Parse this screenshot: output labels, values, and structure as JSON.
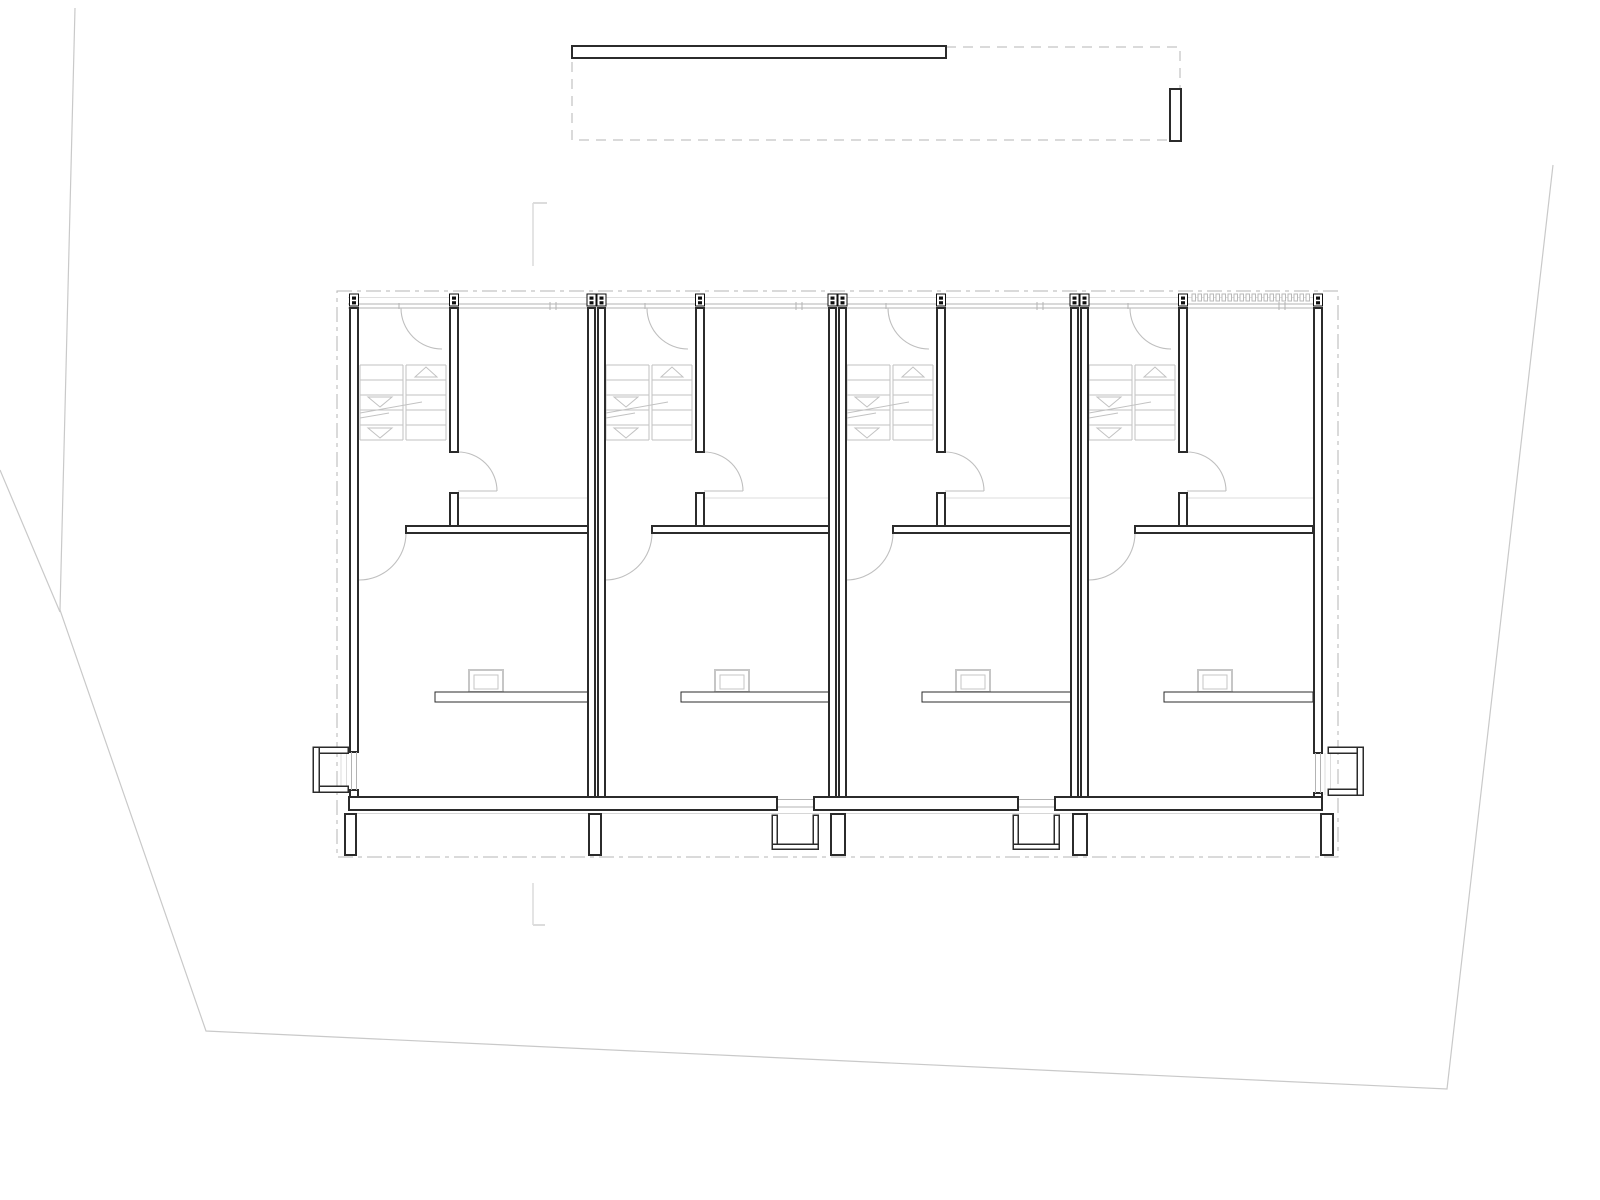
{
  "sheet": {
    "width": 1600,
    "height": 1200,
    "background": "#ffffff",
    "content": "architectural floor plan, four identical row-house units with switchback stairs, door swings, roof outline above, dashed site datum rectangle, faint parcel boundary lines"
  },
  "palette": {
    "wall_stroke": "#2b2b2b",
    "wall_fill": "#ffffff",
    "thin": "#c2c2c2",
    "door": "#bfbfbf",
    "window": "#b3b3b3",
    "faint": "#dcdcdc",
    "eaves": "#e0e0e0",
    "dash": "#b4b4b4",
    "site": "#c9c9c9",
    "marker": "#0f0f0f",
    "footing": "#d6d6d6"
  },
  "site": {
    "boundary_polyline": [
      [
        75,
        8
      ],
      [
        60,
        610
      ],
      [
        206,
        1031
      ],
      [
        1447,
        1089
      ],
      [
        1553,
        165
      ]
    ],
    "spur_line": [
      0,
      470,
      60,
      612
    ],
    "survey_marks": [
      {
        "line": [
          533,
          203,
          533,
          266
        ],
        "tick": [
          533,
          203,
          547,
          203
        ]
      },
      {
        "line": [
          533,
          883,
          533,
          925
        ],
        "tick": [
          533,
          925,
          545,
          925
        ]
      }
    ]
  },
  "roof": {
    "ridge_bar": [
      572,
      46,
      374,
      12
    ],
    "outline_dashed": [
      572,
      47,
      608,
      93
    ],
    "end_bar": [
      1170,
      89,
      11,
      52
    ]
  },
  "plan": {
    "boundary_dashdot": [
      337,
      291,
      1001,
      566
    ],
    "eaves_line": {
      "y": 297.5,
      "x1": 348,
      "x2": 1322
    },
    "window_line": {
      "y1": 304,
      "y2": 308,
      "x1": 348,
      "x2": 1322
    },
    "wall_top_y": 308,
    "left_wall": {
      "x": 350,
      "w": 8,
      "opening": [
        752,
        790
      ],
      "corner_y": 797
    },
    "right_wall": {
      "x": 1314,
      "w": 8,
      "opening": [
        753,
        793
      ],
      "corner_y": 797
    },
    "party_wall_x": [
      588,
      598,
      829,
      839,
      1071,
      1081
    ],
    "party_wall_w": 7,
    "party_wall_y2": 797,
    "bottom_wall": {
      "y": 797,
      "h": 13,
      "x1": 349,
      "x2": 1322,
      "footing_y": 813.5
    },
    "units": [
      {
        "L": 359,
        "R": 588,
        "entry": "left"
      },
      {
        "L": 605,
        "R": 829,
        "entry": "bottom"
      },
      {
        "L": 846,
        "R": 1071,
        "entry": "bottom"
      },
      {
        "L": 1088,
        "R": 1313,
        "entry": "right",
        "louvers": true
      }
    ],
    "unit": {
      "stair": {
        "cols": [
          [
            1,
            44
          ],
          [
            47,
            87
          ]
        ],
        "y1": 365,
        "y2": 440,
        "step": 15,
        "up_triangle": {
          "cx": 67,
          "apex_y": 367,
          "base_y": 377,
          "hw": 11
        },
        "down_triangles": [
          {
            "cx": 21,
            "top_y": 397,
            "apex_y": 407,
            "hw": 12
          },
          {
            "cx": 21,
            "top_y": 428,
            "apex_y": 438,
            "hw": 12
          }
        ],
        "break_lines": [
          [
            1,
            413,
            63,
            402
          ],
          [
            1,
            418,
            30,
            413
          ]
        ]
      },
      "inner_wall": {
        "x": 91,
        "w": 8,
        "y1": 308,
        "y2": 452
      },
      "stub_wall": {
        "x": 91,
        "w": 8,
        "y1": 493,
        "y2": 527
      },
      "cross_wall": {
        "x1": 47,
        "y": 526,
        "h": 7
      },
      "floor_line": {
        "x1": 99,
        "y": 498
      },
      "counter": {
        "x1": 76,
        "y": 692,
        "h": 10
      },
      "sink": {
        "x": 110,
        "y": 670,
        "w": 34,
        "h": 22,
        "inset": 5
      },
      "door_top": {
        "jambs": [
          42,
          83
        ],
        "r": 41
      },
      "door_hall": {
        "hinge_x": 99,
        "y": 491,
        "r": 39
      },
      "door_room": {
        "r": 47
      },
      "window_ticks": [
        191,
        197
      ],
      "jamb_tick": 40,
      "bottom_opening": [
        172,
        209
      ],
      "entry_stoop": [
        167,
        213
      ]
    },
    "markers": {
      "y": 294,
      "w": 9,
      "h": 12,
      "centers": [
        354,
        454,
        591.5,
        601.5,
        700,
        832.5,
        842.5,
        941,
        1074.5,
        1084.5,
        1183,
        1318
      ]
    },
    "louvers": {
      "x1": 1192,
      "x2": 1312,
      "y": 294,
      "h": 7,
      "w": 3.5,
      "pitch": 6
    },
    "piers": {
      "y": 814,
      "h": 41,
      "items": [
        [
          345,
          11
        ],
        [
          589,
          12
        ],
        [
          831,
          14
        ],
        [
          1073,
          14
        ],
        [
          1321,
          12
        ]
      ]
    },
    "side_stoops": [
      {
        "side": "left",
        "x": 313,
        "y": 747,
        "w": 35,
        "h": 45,
        "t": 6
      },
      {
        "side": "right",
        "x": 1328,
        "y": 747,
        "w": 35,
        "h": 48,
        "t": 6
      }
    ],
    "entry_recess_lines": [
      [
        341,
        748,
        341,
        792
      ],
      [
        346.5,
        748,
        346.5,
        792
      ],
      [
        1325,
        753,
        1325,
        795
      ],
      [
        1330.5,
        753,
        1330.5,
        795
      ]
    ]
  }
}
